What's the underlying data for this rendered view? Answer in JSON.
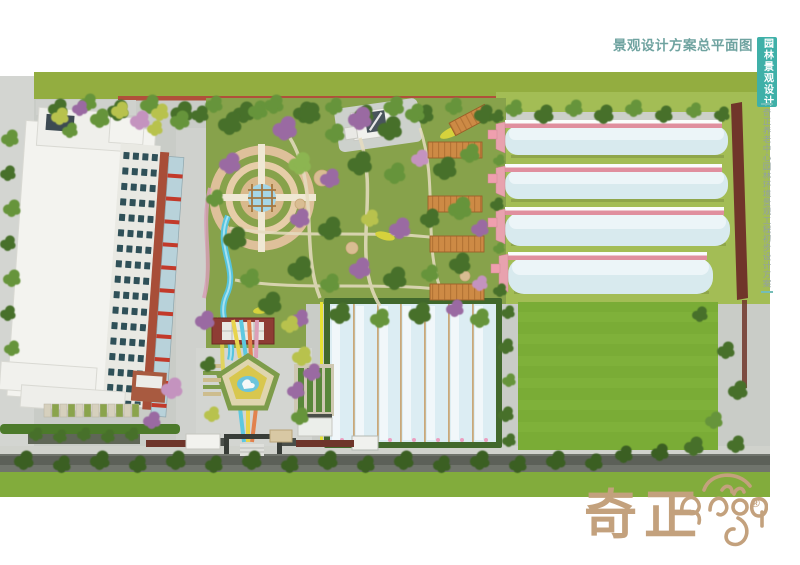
{
  "header": {
    "title": "景观设计方案总平面图"
  },
  "side_tab": {
    "label": "园林景观设计"
  },
  "side_caption": {
    "text": "奇正养老中心园林环境景观工程初步设计方案"
  },
  "logo": {
    "wordmark": "奇正",
    "registered_mark": "®"
  },
  "palette": {
    "accent_teal": "#3fb0a8",
    "title_teal_gray": "#6fa3a0",
    "caption_gray": "#92a1a2",
    "logo_tan": "#c3a17d",
    "garden_grass": "#87a24b",
    "crop_field_green": "#7aac36",
    "tree_dark_green": "#47702a",
    "blossom_purple": "#9a6ba2",
    "greenhouse_glass_blue": "#d8eaee",
    "greenhouse_pink": "#e08f9e",
    "brick_red": "#a84e38",
    "boundary_wall_red": "#70352a",
    "stream_blue": "#56c4de",
    "road_gray": "#c9ccc7"
  }
}
